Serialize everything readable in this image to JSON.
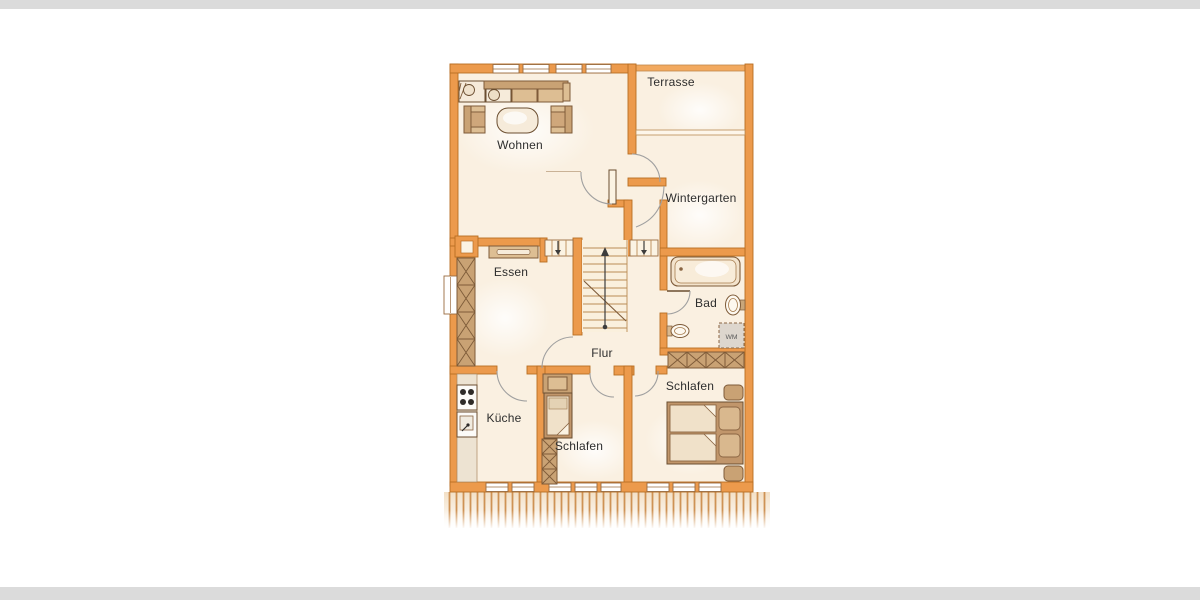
{
  "rooms": {
    "terrasse": "Terrasse",
    "wohnen": "Wohnen",
    "wintergarten": "Wintergarten",
    "essen": "Essen",
    "bad": "Bad",
    "flur": "Flur",
    "kueche": "Küche",
    "schlafen_small": "Schlafen",
    "schlafen_main": "Schlafen"
  },
  "appliances": {
    "washing_machine": "WM"
  },
  "colors": {
    "wall": "#EC9A4C",
    "wall_outline": "#B96E23",
    "floor": "#FAF0E1",
    "furniture_light": "#DDBE93",
    "furniture_dark": "#C9A274",
    "fringe_line": "#CE9254",
    "label_text": "#2E2E2E",
    "page_strip": "#DBDBDB"
  }
}
